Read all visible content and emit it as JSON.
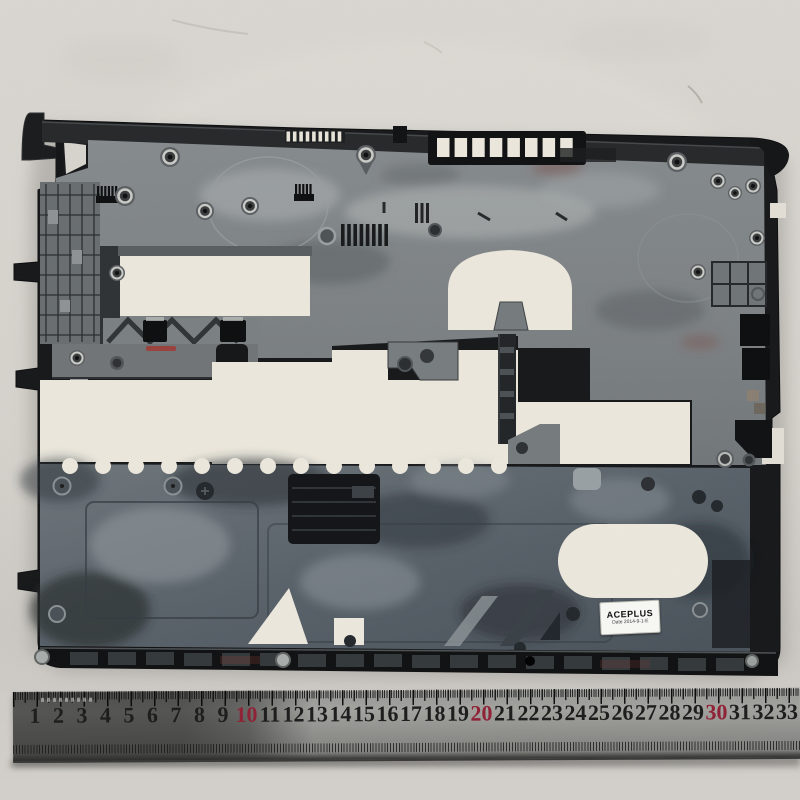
{
  "scene": {
    "type": "product-photo",
    "subject": "Laptop bottom case (inner side) lying on foam, steel ruler below for scale",
    "background_color": "#d6d3cd",
    "cutout_backing_color": "#ece8dd"
  },
  "case_part": {
    "body_color": "#17181a",
    "deck_color": "#7f8487",
    "battery_bay_color": "#5a626a",
    "metal_insert_color": "#c9cbc7",
    "red_paint_mark_color": "#a13a34"
  },
  "label": {
    "brand": "ACEPLUS",
    "date_line": "Date 2014-9-1-E",
    "bg_color": "#f6f6f2",
    "text_color": "#121212"
  },
  "ruler": {
    "numbers": [
      "1",
      "2",
      "3",
      "4",
      "5",
      "6",
      "7",
      "8",
      "9",
      "10",
      "11",
      "12",
      "13",
      "14",
      "15",
      "16",
      "17",
      "18",
      "19",
      "20",
      "21",
      "22",
      "23",
      "24",
      "25",
      "26",
      "27",
      "28",
      "29",
      "30",
      "31",
      "32",
      "33"
    ],
    "red_numbers": [
      "10",
      "20",
      "30"
    ],
    "number_color": "#1e1e1e",
    "red_color": "#8f2236",
    "metal_color": "#8f8f8d"
  }
}
